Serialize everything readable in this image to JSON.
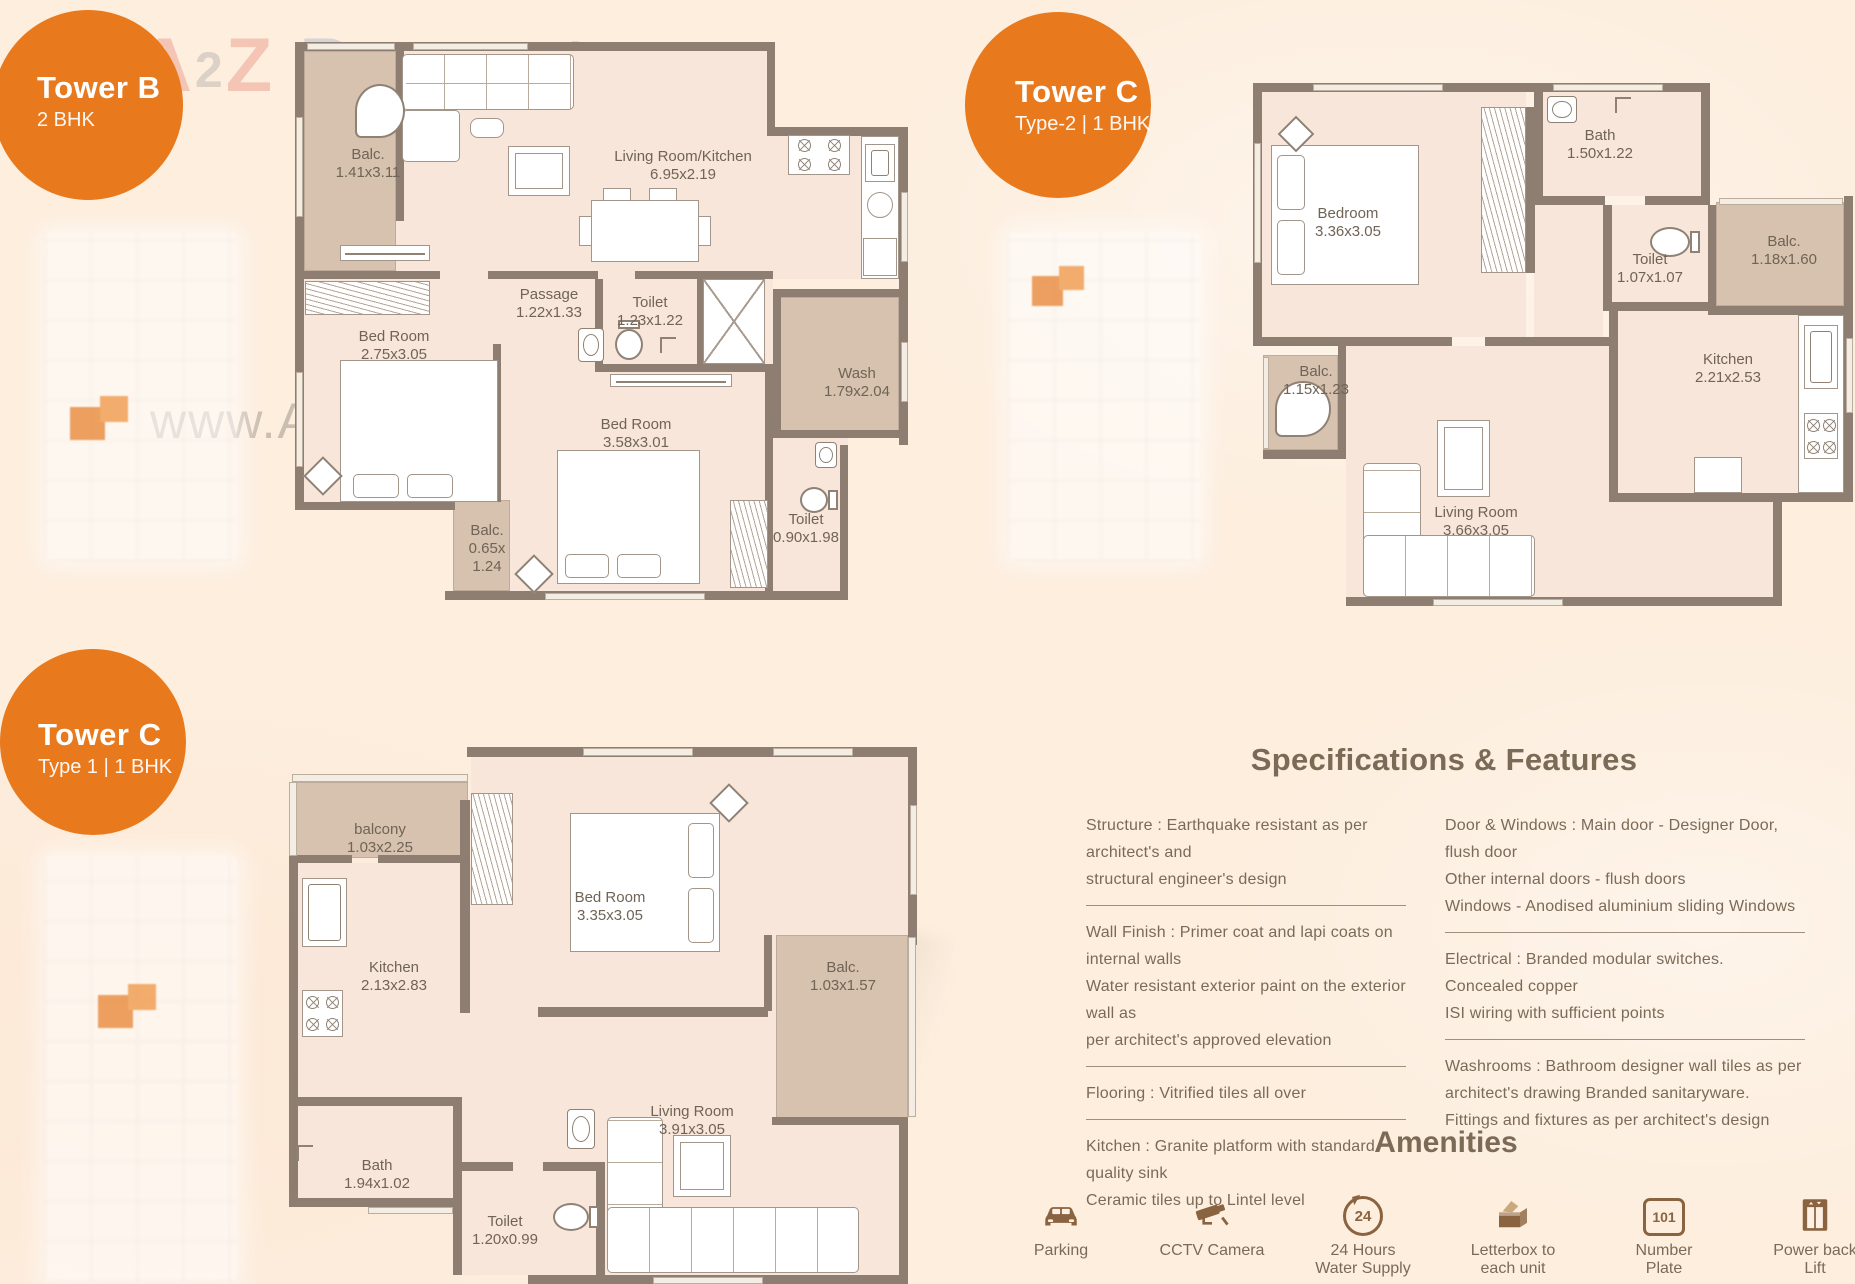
{
  "colors": {
    "orange": "#e8791d",
    "wall": "#8d7e71",
    "pink": "#f8e6da",
    "tan": "#d7c1af",
    "text": "#6f6455",
    "spec": "#7b6a58",
    "amenity": "#8a6340",
    "background": "#fdeede"
  },
  "watermark": {
    "url": "www.A2ZProperty.in",
    "logo": [
      {
        "ch": "A",
        "c": "#e06a5a"
      },
      {
        "ch": "2",
        "c": "#909090"
      },
      {
        "ch": "Z",
        "c": "#e06a5a"
      },
      {
        "ch": "P",
        "c": "#7f9ad0"
      },
      {
        "ch": "r",
        "c": "#e08a7a"
      },
      {
        "ch": "o",
        "c": "#e0a070"
      },
      {
        "ch": "p",
        "c": "#86aede"
      },
      {
        "ch": "e",
        "c": "#e0c060"
      },
      {
        "ch": "r",
        "c": "#98c089"
      },
      {
        "ch": "t",
        "c": "#6fb0c8"
      },
      {
        "ch": "y",
        "c": "#90c080"
      }
    ]
  },
  "badges": {
    "towerB": {
      "title": "Tower B",
      "subtitle": "2 BHK"
    },
    "towerC2": {
      "title": "Tower C",
      "subtitle": "Type-2 | 1 BHK"
    },
    "towerC1": {
      "title": "Tower C",
      "subtitle": "Type 1 | 1 BHK"
    }
  },
  "plans": {
    "towerB": {
      "rooms": {
        "balc1": {
          "name": "Balc.",
          "dim": "1.41x3.11"
        },
        "living": {
          "name": "Living Room/Kitchen",
          "dim": "6.95x2.19"
        },
        "passage": {
          "name": "Passage",
          "dim": "1.22x1.33"
        },
        "toilet1": {
          "name": "Toilet",
          "dim": "1.23x1.22"
        },
        "bed1": {
          "name": "Bed Room",
          "dim": "2.75x3.05"
        },
        "bed2": {
          "name": "Bed Room",
          "dim": "3.58x3.01"
        },
        "wash": {
          "name": "Wash",
          "dim": "1.79x2.04"
        },
        "balc2": {
          "name": "Balc.",
          "dim": "0.65x",
          "dim2": "1.24"
        },
        "toilet2": {
          "name": "Toilet",
          "dim": "0.90x1.98"
        }
      }
    },
    "towerC2": {
      "rooms": {
        "bedroom": {
          "name": "Bedroom",
          "dim": "3.36x3.05"
        },
        "bath": {
          "name": "Bath",
          "dim": "1.50x1.22"
        },
        "toilet": {
          "name": "Toilet",
          "dim": "1.07x1.07"
        },
        "balc1": {
          "name": "Balc.",
          "dim": "1.18x1.60"
        },
        "kitchen": {
          "name": "Kitchen",
          "dim": "2.21x2.53"
        },
        "balc2": {
          "name": "Balc.",
          "dim": "1.15x1.23"
        },
        "living": {
          "name": "Living Room",
          "dim": "3.66x3.05"
        }
      }
    },
    "towerC1": {
      "rooms": {
        "balcony": {
          "name": "balcony",
          "dim": "1.03x2.25"
        },
        "kitchen": {
          "name": "Kitchen",
          "dim": "2.13x2.83"
        },
        "bed": {
          "name": "Bed Room",
          "dim": "3.35x3.05"
        },
        "balc": {
          "name": "Balc.",
          "dim": "1.03x1.57"
        },
        "bath": {
          "name": "Bath",
          "dim": "1.94x1.02"
        },
        "toilet": {
          "name": "Toilet",
          "dim": "1.20x0.99"
        },
        "living": {
          "name": "Living Room",
          "dim": "3.91x3.05"
        }
      }
    }
  },
  "specs": {
    "title": "Specifications & Features",
    "left": [
      {
        "lines": [
          "Structure : Earthquake resistant as per architect's and",
          "structural engineer's design"
        ]
      },
      {
        "lines": [
          "Wall Finish : Primer coat and lapi coats on internal walls",
          "Water resistant exterior paint on the exterior wall as",
          "per architect's approved elevation"
        ]
      },
      {
        "lines": [
          "Flooring : Vitrified tiles all over"
        ]
      },
      {
        "lines": [
          "Kitchen : Granite platform with standard quality sink",
          "Ceramic tiles up to Lintel  level"
        ]
      }
    ],
    "right": [
      {
        "lines": [
          "Door & Windows : Main door - Designer Door, flush door",
          "Other internal doors - flush doors",
          "Windows - Anodised aluminium sliding Windows"
        ]
      },
      {
        "lines": [
          "Electrical : Branded modular switches. Concealed copper",
          "ISI wiring with sufficient points"
        ]
      },
      {
        "lines": [
          "Washrooms : Bathroom designer wall tiles as per",
          "architect's drawing Branded sanitaryware.",
          "Fittings and fixtures as per architect's design"
        ]
      }
    ]
  },
  "amenities": {
    "title": "Amenities",
    "items": [
      {
        "id": "parking",
        "line1": "Parking",
        "line2": ""
      },
      {
        "id": "cctv",
        "line1": "CCTV Camera",
        "line2": ""
      },
      {
        "id": "water",
        "badge": "24",
        "line1": "24 Hours",
        "line2": "Water Supply"
      },
      {
        "id": "letterbox",
        "line1": "Letterbox to",
        "line2": "each unit"
      },
      {
        "id": "numberplate",
        "badge": "101",
        "line1": "Number",
        "line2": "Plate"
      },
      {
        "id": "lift",
        "line1": "Power back",
        "line2": "Lift"
      }
    ]
  }
}
